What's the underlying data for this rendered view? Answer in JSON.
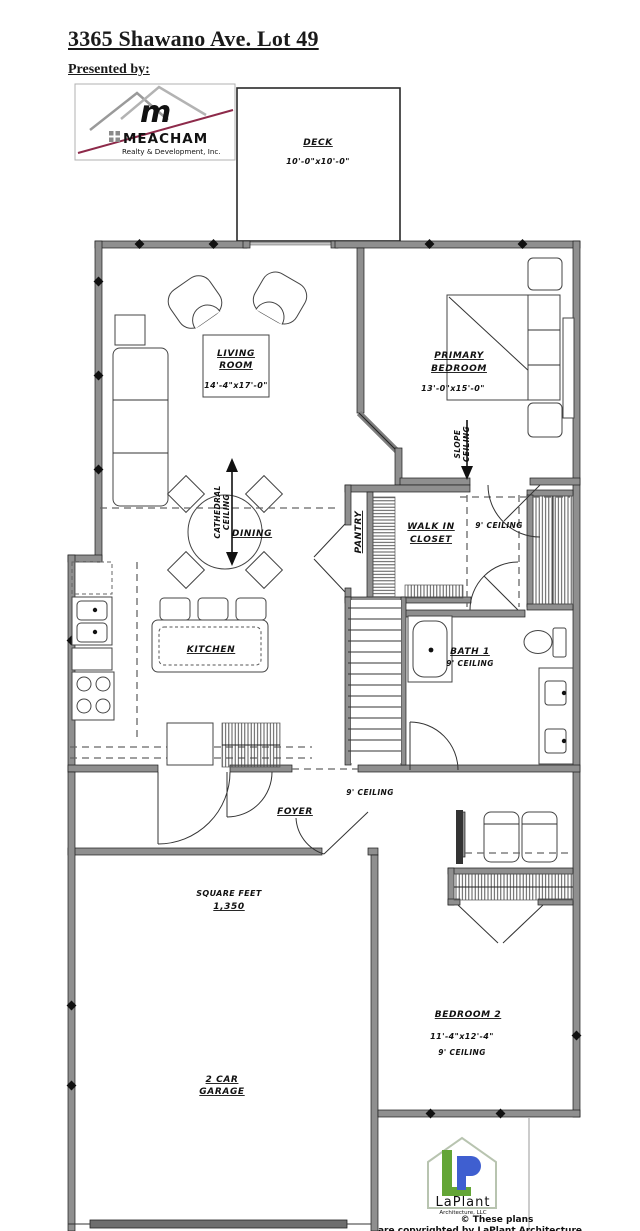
{
  "header": {
    "title": "3365 Shawano Ave. Lot 49",
    "presented_by": "Presented by:"
  },
  "meacham_logo": {
    "name": "MEACHAM",
    "monogram": "m",
    "tagline": "Realty & Development, Inc.",
    "accent": "#8d2a4a"
  },
  "plan": {
    "deck": {
      "name": "DECK",
      "dims": "10'-0\"x10'-0\""
    },
    "living_room": {
      "name_line1": "LIVING",
      "name_line2": "ROOM",
      "dims": "14'-4\"x17'-0\""
    },
    "primary_bedroom": {
      "name_line1": "PRIMARY",
      "name_line2": "BEDROOM",
      "dims": "13'-0\"x15'-0\""
    },
    "slope_ceiling": {
      "line1": "SLOPE",
      "line2": "CEILING"
    },
    "cathedral_ceiling": {
      "line1": "CATHEDRAL",
      "line2": "CEILING"
    },
    "dining": {
      "name": "DINING"
    },
    "pantry": {
      "name": "PANTRY"
    },
    "walk_in_closet": {
      "name_line1": "WALK IN",
      "name_line2": "CLOSET"
    },
    "hall": {
      "note": "9' CEILING"
    },
    "bath1": {
      "name": "BATH 1",
      "note": "9' CEILING"
    },
    "kitchen": {
      "name": "KITCHEN"
    },
    "foyer": {
      "name": "FOYER",
      "note": "9' CEILING"
    },
    "square_feet": {
      "label": "SQUARE FEET",
      "value": "1,350"
    },
    "garage": {
      "name_line1": "2 CAR",
      "name_line2": "GARAGE"
    },
    "bedroom2": {
      "name": "BEDROOM 2",
      "dims": "11'-4\"x12'-4\"",
      "note": "9' CEILING"
    }
  },
  "laplant_logo": {
    "name": "LaPlant",
    "sub": "Architecture, LLC",
    "copyright_line1": "© These plans",
    "copyright_line2": "are copyrighted by LaPlant Architecture"
  }
}
